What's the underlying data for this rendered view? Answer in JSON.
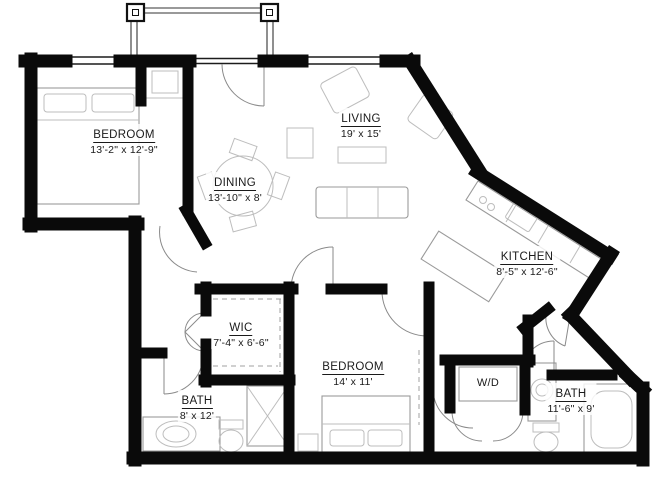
{
  "plan": {
    "type": "apartment-floor-plan",
    "rooms": [
      {
        "id": "bedroom-1",
        "name": "BEDROOM",
        "dims": "13'-2\" x 12'-9\""
      },
      {
        "id": "living",
        "name": "LIVING",
        "dims": "19' x 15'"
      },
      {
        "id": "dining",
        "name": "DINING",
        "dims": "13'-10\" x 8'"
      },
      {
        "id": "kitchen",
        "name": "KITCHEN",
        "dims": "8'-5\" x 12'-6\""
      },
      {
        "id": "wic",
        "name": "WIC",
        "dims": "7'-4\" x 6'-6\""
      },
      {
        "id": "bedroom-2",
        "name": "BEDROOM",
        "dims": "14' x 11'"
      },
      {
        "id": "bath-1",
        "name": "BATH",
        "dims": "8' x 12'"
      },
      {
        "id": "bath-2",
        "name": "BATH",
        "dims": "11'-6\" x 9'"
      }
    ],
    "appliances": [
      {
        "id": "washer-dryer",
        "label": "W/D"
      }
    ],
    "colors": {
      "wall": "#0a0a0a",
      "fixture": "#9a9a9a",
      "text": "#1a1a1a",
      "background": "#ffffff"
    }
  }
}
